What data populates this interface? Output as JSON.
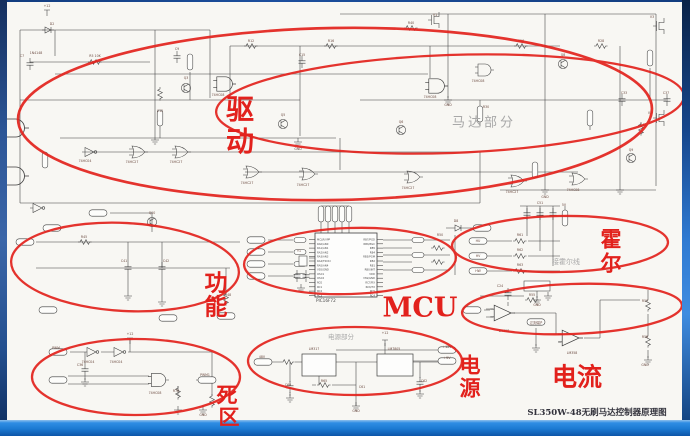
{
  "title_block": {
    "text": "SL350W-48无刷马达控制器原理图"
  },
  "annotations": {
    "color": "#e2211c",
    "drive": {
      "char1": "驱",
      "char2": "动"
    },
    "function": {
      "char1": "功",
      "char2": "能"
    },
    "hall": {
      "char1": "霍",
      "char2": "尔"
    },
    "power": {
      "char1": "电",
      "char2": "源"
    },
    "deadzone": {
      "char1": "死",
      "char2": "区"
    },
    "mcu_label": "MCU",
    "current_label": "电流",
    "motor_area_label": "马达部分",
    "hall_area_label": "接霍尔线",
    "power_area_label": "电源部分"
  },
  "schematic": {
    "ink": "#3d3d3d",
    "mcu_part": "PIC16F72",
    "gray_notes": [
      {
        "x": 110,
        "y": 209,
        "t": "恒电平 输入"
      },
      {
        "x": 89,
        "y": 227,
        "t": "低电平输入"
      }
    ],
    "mcu_pins_left": [
      "MCLR/VPP",
      "RA0/AN0",
      "RA1/AN1",
      "RA2/AN2",
      "RA3/AN3",
      "RA4/T0CKI",
      "RA5/AN4",
      "VSS/GND",
      "OSC1",
      "OSC2",
      "RC0",
      "RC1",
      "RC2",
      "RC3"
    ],
    "mcu_pins_right": [
      "RB7/PGD",
      "RB6/PGC",
      "RB5",
      "RB4",
      "RB3/PGM",
      "RB2",
      "RB1",
      "RB0/INT",
      "VDD",
      "VSS/GND",
      "RC7/RX",
      "RC6/TX",
      "RC5",
      "RC4"
    ],
    "labels": [
      {
        "x": 47,
        "y": 7,
        "t": "+12"
      },
      {
        "x": 52,
        "y": 25,
        "t": "D2"
      },
      {
        "x": 36,
        "y": 54,
        "t": "1N4148"
      },
      {
        "x": 22,
        "y": 57,
        "t": "C7"
      },
      {
        "x": 95,
        "y": 57,
        "t": "R5 10K"
      },
      {
        "x": 177,
        "y": 50,
        "t": "C9"
      },
      {
        "x": 251,
        "y": 42,
        "t": "R12"
      },
      {
        "x": 331,
        "y": 42,
        "t": "R16"
      },
      {
        "x": 411,
        "y": 24,
        "t": "R40"
      },
      {
        "x": 521,
        "y": 42,
        "t": "R26"
      },
      {
        "x": 601,
        "y": 42,
        "t": "R28"
      },
      {
        "x": 435,
        "y": 16,
        "t": "V1"
      },
      {
        "x": 652,
        "y": 18,
        "t": "V3"
      },
      {
        "x": 650,
        "y": 114,
        "t": "V5"
      },
      {
        "x": 624,
        "y": 94,
        "t": "C33"
      },
      {
        "x": 666,
        "y": 94,
        "t": "C37"
      },
      {
        "x": 643,
        "y": 126,
        "t": "R41"
      },
      {
        "x": 186,
        "y": 79,
        "t": "Q3"
      },
      {
        "x": 283,
        "y": 116,
        "t": "Q5"
      },
      {
        "x": 563,
        "y": 56,
        "t": "Q8"
      },
      {
        "x": 631,
        "y": 151,
        "t": "Q9"
      },
      {
        "x": 401,
        "y": 123,
        "t": "Q6"
      },
      {
        "x": 218,
        "y": 96,
        "t": "74HC08"
      },
      {
        "x": 430,
        "y": 98,
        "t": "74HC08"
      },
      {
        "x": 478,
        "y": 82,
        "t": "74HC08"
      },
      {
        "x": 85,
        "y": 162,
        "t": "74HC04"
      },
      {
        "x": 132,
        "y": 163,
        "t": "74HC27"
      },
      {
        "x": 176,
        "y": 163,
        "t": "74HC27"
      },
      {
        "x": 247,
        "y": 184,
        "t": "74HC27"
      },
      {
        "x": 303,
        "y": 186,
        "t": "74HC27"
      },
      {
        "x": 408,
        "y": 189,
        "t": "74HC27"
      },
      {
        "x": 512,
        "y": 193,
        "t": "74HC27"
      },
      {
        "x": 573,
        "y": 191,
        "t": "74HC08"
      },
      {
        "x": 160,
        "y": 112,
        "t": "C12"
      },
      {
        "x": 302,
        "y": 56,
        "t": "C15"
      },
      {
        "x": 486,
        "y": 108,
        "t": "R30"
      },
      {
        "x": 448,
        "y": 106,
        "t": "GND"
      },
      {
        "x": 298,
        "y": 150,
        "t": "GND"
      },
      {
        "x": 545,
        "y": 198,
        "t": "GND"
      },
      {
        "x": 152,
        "y": 214,
        "t": "Q10"
      },
      {
        "x": 84,
        "y": 238,
        "t": "R45"
      },
      {
        "x": 124,
        "y": 262,
        "t": "C41"
      },
      {
        "x": 166,
        "y": 262,
        "t": "C42"
      },
      {
        "x": 228,
        "y": 296,
        "t": "R48"
      },
      {
        "x": 440,
        "y": 236,
        "t": "R50"
      },
      {
        "x": 299,
        "y": 252,
        "t": "Y1"
      },
      {
        "x": 456,
        "y": 222,
        "t": "D8"
      },
      {
        "x": 520,
        "y": 236,
        "t": "R61"
      },
      {
        "x": 520,
        "y": 251,
        "t": "R62"
      },
      {
        "x": 520,
        "y": 266,
        "t": "R63"
      },
      {
        "x": 540,
        "y": 204,
        "t": "C51"
      },
      {
        "x": 564,
        "y": 206,
        "t": "5V"
      },
      {
        "x": 478,
        "y": 242,
        "t": "HU"
      },
      {
        "x": 478,
        "y": 257,
        "t": "HV"
      },
      {
        "x": 478,
        "y": 272,
        "t": "HW"
      },
      {
        "x": 537,
        "y": 306,
        "t": "GND"
      },
      {
        "x": 88,
        "y": 363,
        "t": "74HC04"
      },
      {
        "x": 116,
        "y": 363,
        "t": "74HC04"
      },
      {
        "x": 155,
        "y": 394,
        "t": "74HC08"
      },
      {
        "x": 56,
        "y": 349,
        "t": "PWM"
      },
      {
        "x": 205,
        "y": 376,
        "t": "PWM1"
      },
      {
        "x": 80,
        "y": 366,
        "t": "C36"
      },
      {
        "x": 176,
        "y": 392,
        "t": "R70"
      },
      {
        "x": 130,
        "y": 335,
        "t": "+12"
      },
      {
        "x": 203,
        "y": 416,
        "t": "GND"
      },
      {
        "x": 314,
        "y": 350,
        "t": "LM317"
      },
      {
        "x": 394,
        "y": 350,
        "t": "LM7805"
      },
      {
        "x": 262,
        "y": 358,
        "t": "48V"
      },
      {
        "x": 447,
        "y": 348,
        "t": "+12V"
      },
      {
        "x": 447,
        "y": 359,
        "t": "+5V"
      },
      {
        "x": 288,
        "y": 386,
        "t": "C60"
      },
      {
        "x": 362,
        "y": 388,
        "t": "C61"
      },
      {
        "x": 424,
        "y": 382,
        "t": "C62"
      },
      {
        "x": 324,
        "y": 382,
        "t": "R65"
      },
      {
        "x": 385,
        "y": 334,
        "t": "+12"
      },
      {
        "x": 356,
        "y": 412,
        "t": "GND"
      },
      {
        "x": 504,
        "y": 332,
        "t": "LM358"
      },
      {
        "x": 572,
        "y": 354,
        "t": "LM358"
      },
      {
        "x": 500,
        "y": 287,
        "t": "C24"
      },
      {
        "x": 536,
        "y": 324,
        "t": "过流保护"
      },
      {
        "x": 645,
        "y": 302,
        "t": "R57"
      },
      {
        "x": 645,
        "y": 338,
        "t": "R58"
      },
      {
        "x": 532,
        "y": 296,
        "t": "R55"
      },
      {
        "x": 645,
        "y": 366,
        "t": "GND"
      }
    ]
  }
}
